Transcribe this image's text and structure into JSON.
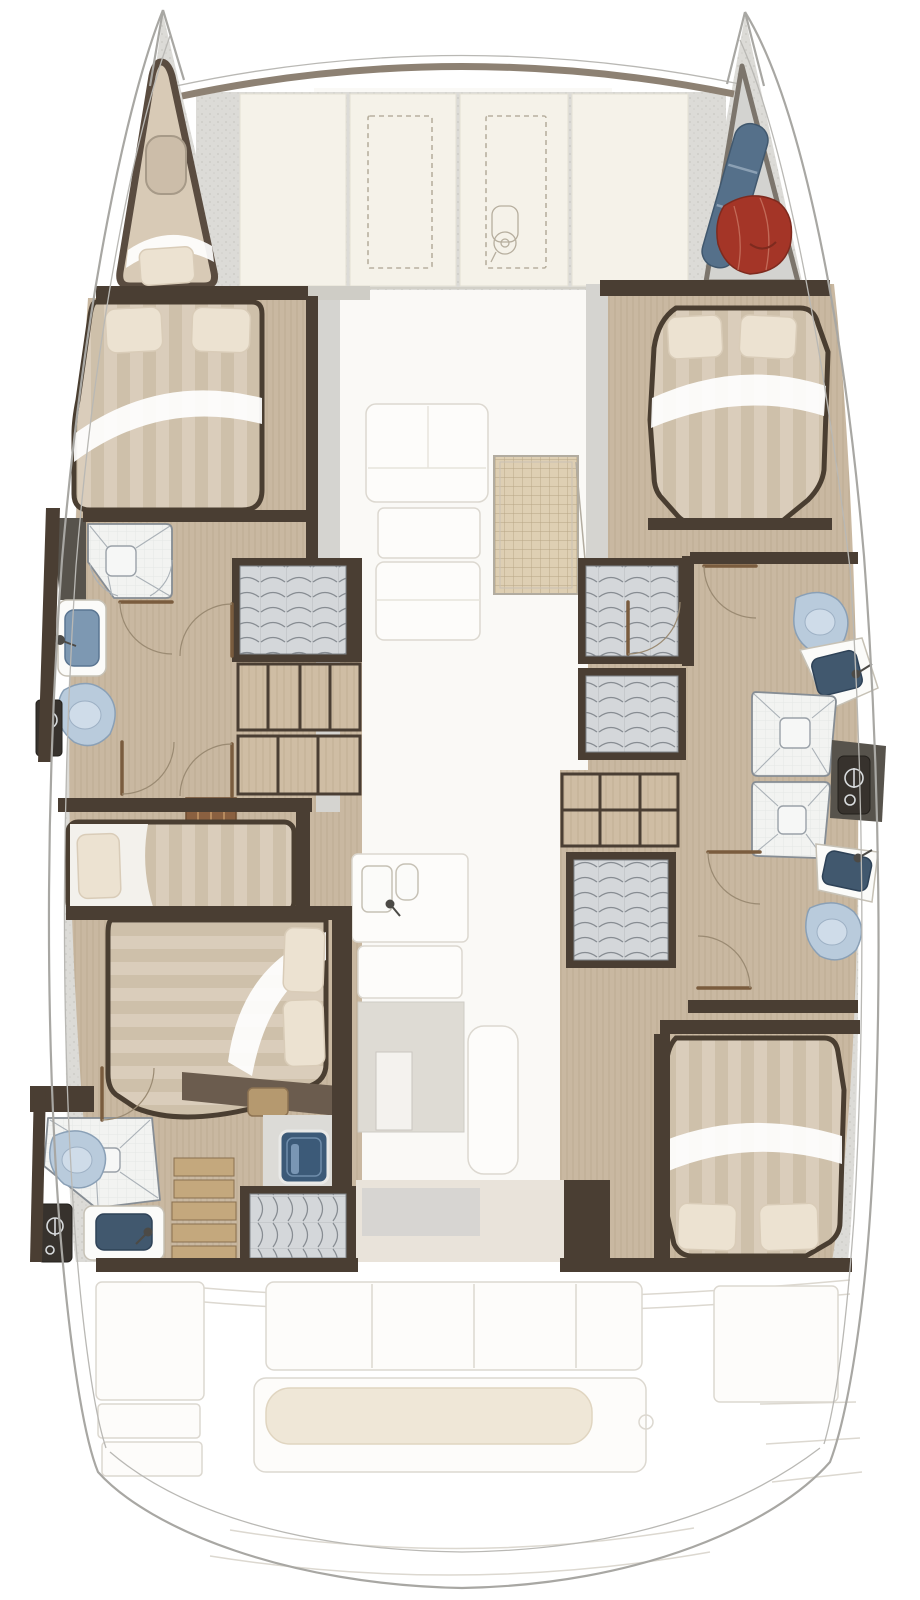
{
  "palette": {
    "wall": "#4a3e33",
    "wall_mid": "#6b5c4e",
    "band": "#8d8173",
    "floor": "#c9b8a1",
    "deck": "#dcdbd7",
    "panel": "#f5f2e9",
    "ghost_fill": "#fdfcfa",
    "ghost_line": "#dcd8d0",
    "bed_stripe_a": "#dacdbb",
    "bed_stripe_b": "#cec0aa",
    "pillow": "#ece2d1",
    "tile": "#f2f3f1",
    "sink": "#41586e",
    "sink_light": "#7d98b2",
    "toilet": "#b9cbdc",
    "column": "#37322d",
    "locker": "#d4d7da",
    "steps": "#c4a87d",
    "hatch_blue": "#3c5a78",
    "grid": "#decfb3",
    "bag_red": "#a43527",
    "roll_blue": "#55708a",
    "cushion": "#efe7d7",
    "door": "#7a5c3e",
    "wood_dark": "#8a6040",
    "nightstand": "#b5996f",
    "aft_panel": "#e9e3da"
  },
  "plan": {
    "type": "catamaran-floor-plan",
    "areas": [
      "foredeck",
      "port-bow-locker",
      "starboard-bow-storage",
      "port-forward-cabin",
      "port-forward-head",
      "port-mid-cabin",
      "port-aft-head",
      "starboard-forward-cabin",
      "starboard-head-forward",
      "starboard-head-aft",
      "starboard-aft-cabin",
      "saloon-galley",
      "cockpit"
    ],
    "fixtures": {
      "double_beds": 4,
      "single_berths": 2,
      "toilets": 4,
      "shower_trays": 4,
      "sinks": 5,
      "hanging_lockers": 5,
      "door_swings": 9,
      "deck_hatches": 2
    },
    "bow_gear": [
      "blue-roll",
      "red-bag"
    ]
  }
}
